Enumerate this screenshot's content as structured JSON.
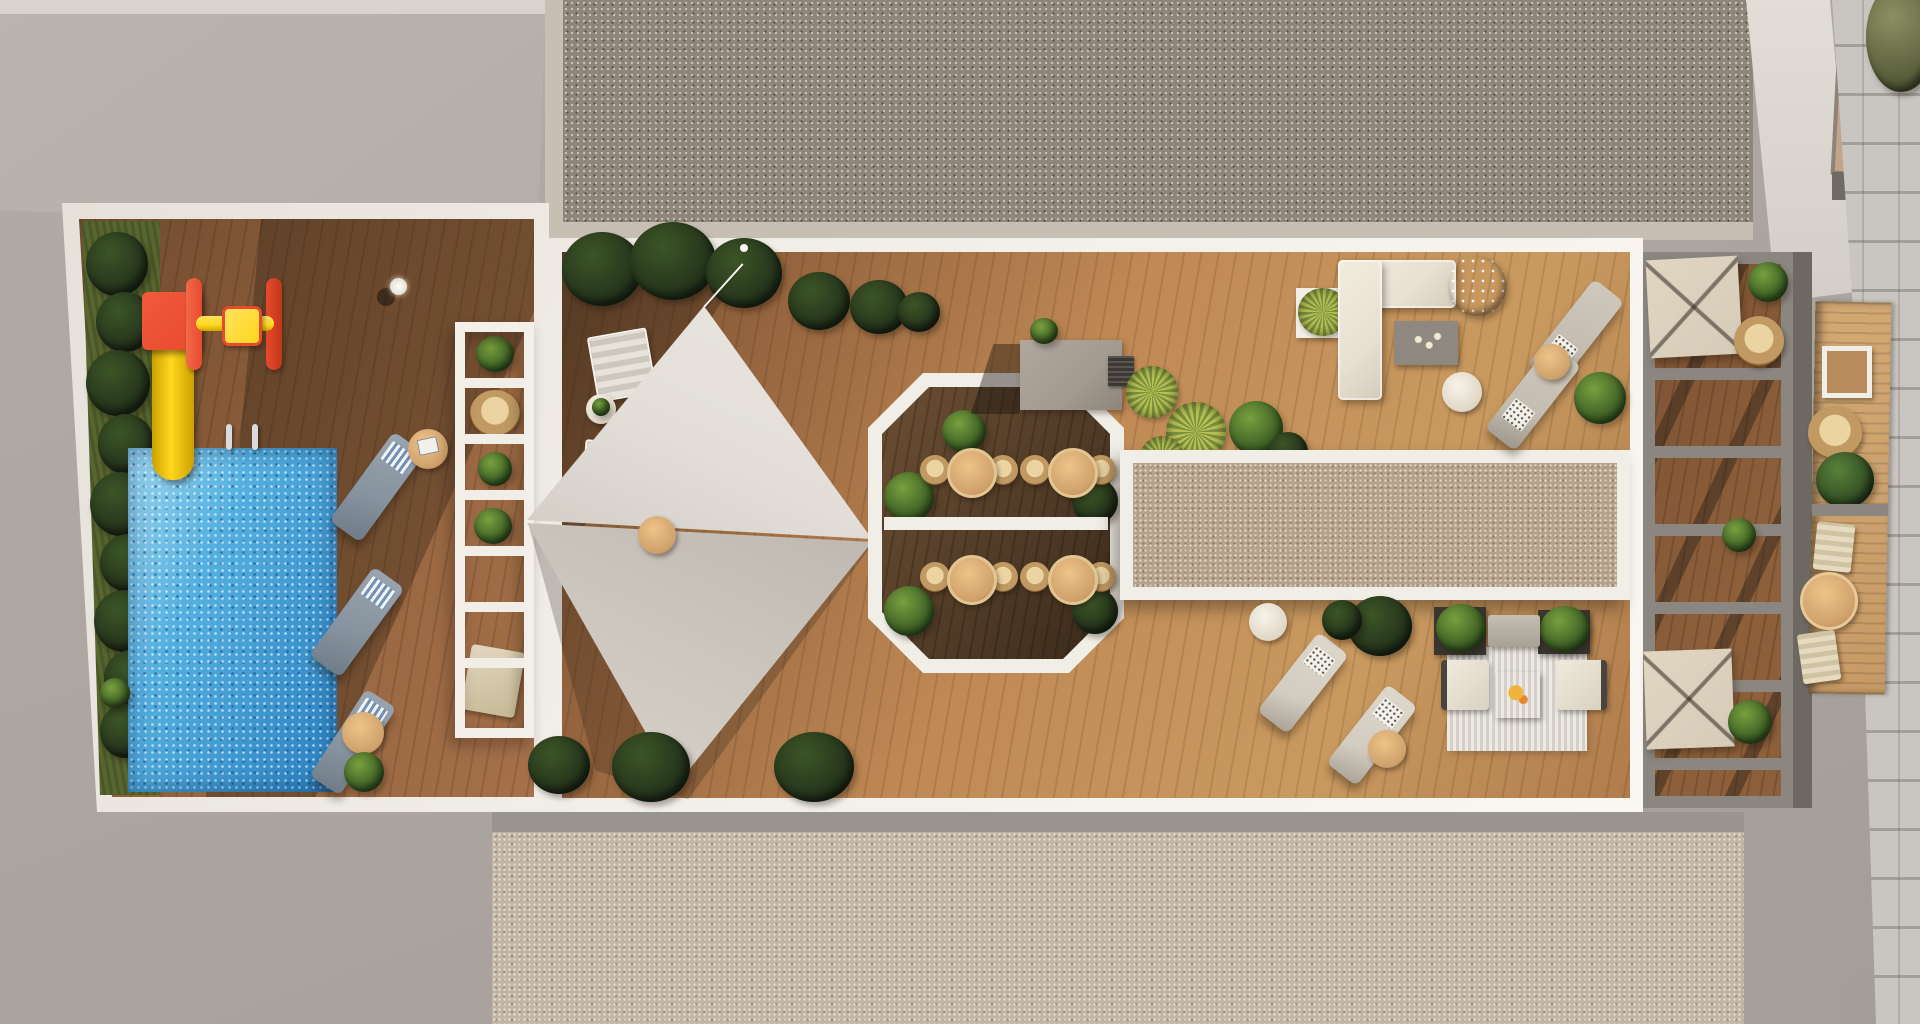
{
  "meta": {
    "title": "Aerial architectural render of a residential rooftop amenity terrace",
    "view": "top-down 3D visualization, no visible text or UI controls",
    "width_px": 1920,
    "height_px": 1024
  },
  "colors": {
    "ground": "#aba49f",
    "groundLight": "#b5aeaa",
    "parapet": "#d8d3cd",
    "gravelRoof": "#8e8678",
    "gravelEdge": "#c8bfb4",
    "gravelLower": "#c2b5a4",
    "gravelCourt": "#b5a28b",
    "paver": "#c9c5c0",
    "slabWhite": "#f1ede7",
    "woodShaded": "#6e4a2e",
    "woodMain": "#96653f",
    "woodSunlit": "#c08955",
    "woodOctagon": "#4f3a26",
    "woodBalcony": "#c79a66",
    "woodPergola": "#8d5f3b",
    "poolBlue": "#54b0e0",
    "poolDeep": "#2a7fc0",
    "slideYellow": "#ffd71e",
    "slideRed": "#e84a2e",
    "grass": "#57652f",
    "plantDark": "#22301b",
    "plantMid": "#3c5526",
    "plantBright": "#79a03f",
    "plantOlive": "#7d9140",
    "spikyYellow": "#b9c254",
    "sailLight": "#e3ded8",
    "sailShaded": "#c9c3bb",
    "loungerGray": "#86929d",
    "loungerBeige": "#c4bcb0",
    "loungerCream": "#d3ccc0",
    "cushionCream": "#e8e1d3",
    "tableWood": "#cfa06b",
    "rattan": "#c09a62",
    "serviceBlock": "#a39a90",
    "frameGray": "#8b8680",
    "canopyBeige": "#d6cbb8",
    "rugBeige": "#d4cfc7",
    "coffeeTable": "#8f8880",
    "planterDark": "#3a352f",
    "balconyTan": "#c2a48c"
  },
  "scene": {
    "surroundings": {
      "label": "street level and neighbouring roofs",
      "items": [
        "concrete ground",
        "upper gravel roof",
        "lower gravel roof",
        "paver sidewalk",
        "adjacent building roof with tan balcony",
        "street tree canopy"
      ]
    },
    "pool_zone": {
      "label": "pool and play deck",
      "items": [
        "swimming pool with sparkling water",
        "yellow water slide with red platform",
        "red-yellow spinner toy",
        "hedge strip with dark shrubs",
        "3 gray sun loungers with striped towels",
        "round side tables",
        "white trellis walkway with plants and wicker chair",
        "pool handrails",
        "light post"
      ]
    },
    "sail_zone": {
      "label": "shade sail deck",
      "items": [
        "two triangular shade sails",
        "tension ropes",
        "2 white folding deck chairs",
        "plant side table",
        "round towel table",
        "dark shrub planters along edges"
      ]
    },
    "dining_octagon": {
      "label": "octagonal outdoor dining nook",
      "items": [
        "white octagonal frame",
        "dark wood floor",
        "center divider",
        "4 round dining tables",
        "8 wicker dining chairs",
        "corner shrubs"
      ]
    },
    "lounge_zone": {
      "label": "east lounge deck",
      "items": [
        "cream L-shaped sectional sofa",
        "gray coffee table with cups",
        "flowering shrub",
        "service block roof",
        "floor grate",
        "yucca plants",
        "pebble court with white frame",
        "4 beige sun loungers",
        "round side tables",
        "striped lounge rug",
        "2 cream armchairs",
        "bench",
        "2 dark planters",
        "patio table with plate"
      ]
    },
    "pergola_zone": {
      "label": "slatted pergola over lower terrace",
      "items": [
        "gray pergola beams",
        "2 beige square canopies",
        "hanging rattan egg chair",
        "green shrubs"
      ]
    },
    "balcony_strip": {
      "label": "neighbouring balcony strip",
      "items": [
        "narrow wood deck",
        "white framed table",
        "round rattan chair",
        "shrub",
        "gray divider",
        "2 beige folding chairs",
        "round wood table"
      ]
    }
  }
}
